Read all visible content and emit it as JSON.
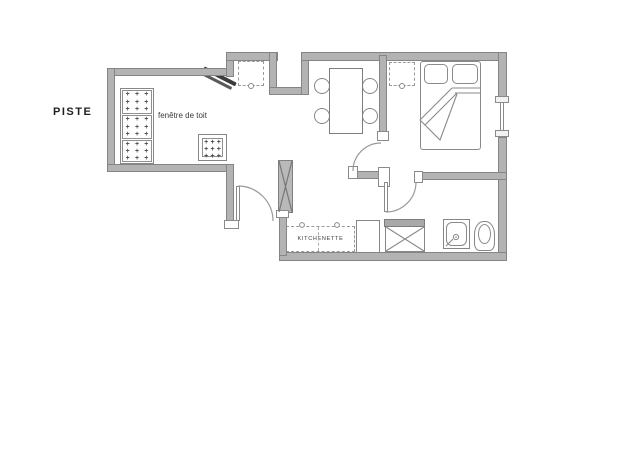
{
  "labels": {
    "piste": "PISTE",
    "roof_window": "fenêtre de toit",
    "kitchenette": "KITCHENETTE"
  },
  "marks": {
    "cushion": "+"
  },
  "colors": {
    "background": "#ffffff",
    "wall_fill": "#b3b3b3",
    "wall_edge": "#858585",
    "furniture_line": "#878787",
    "tv": "#3c3c3c",
    "text": "#2e2e2e"
  }
}
